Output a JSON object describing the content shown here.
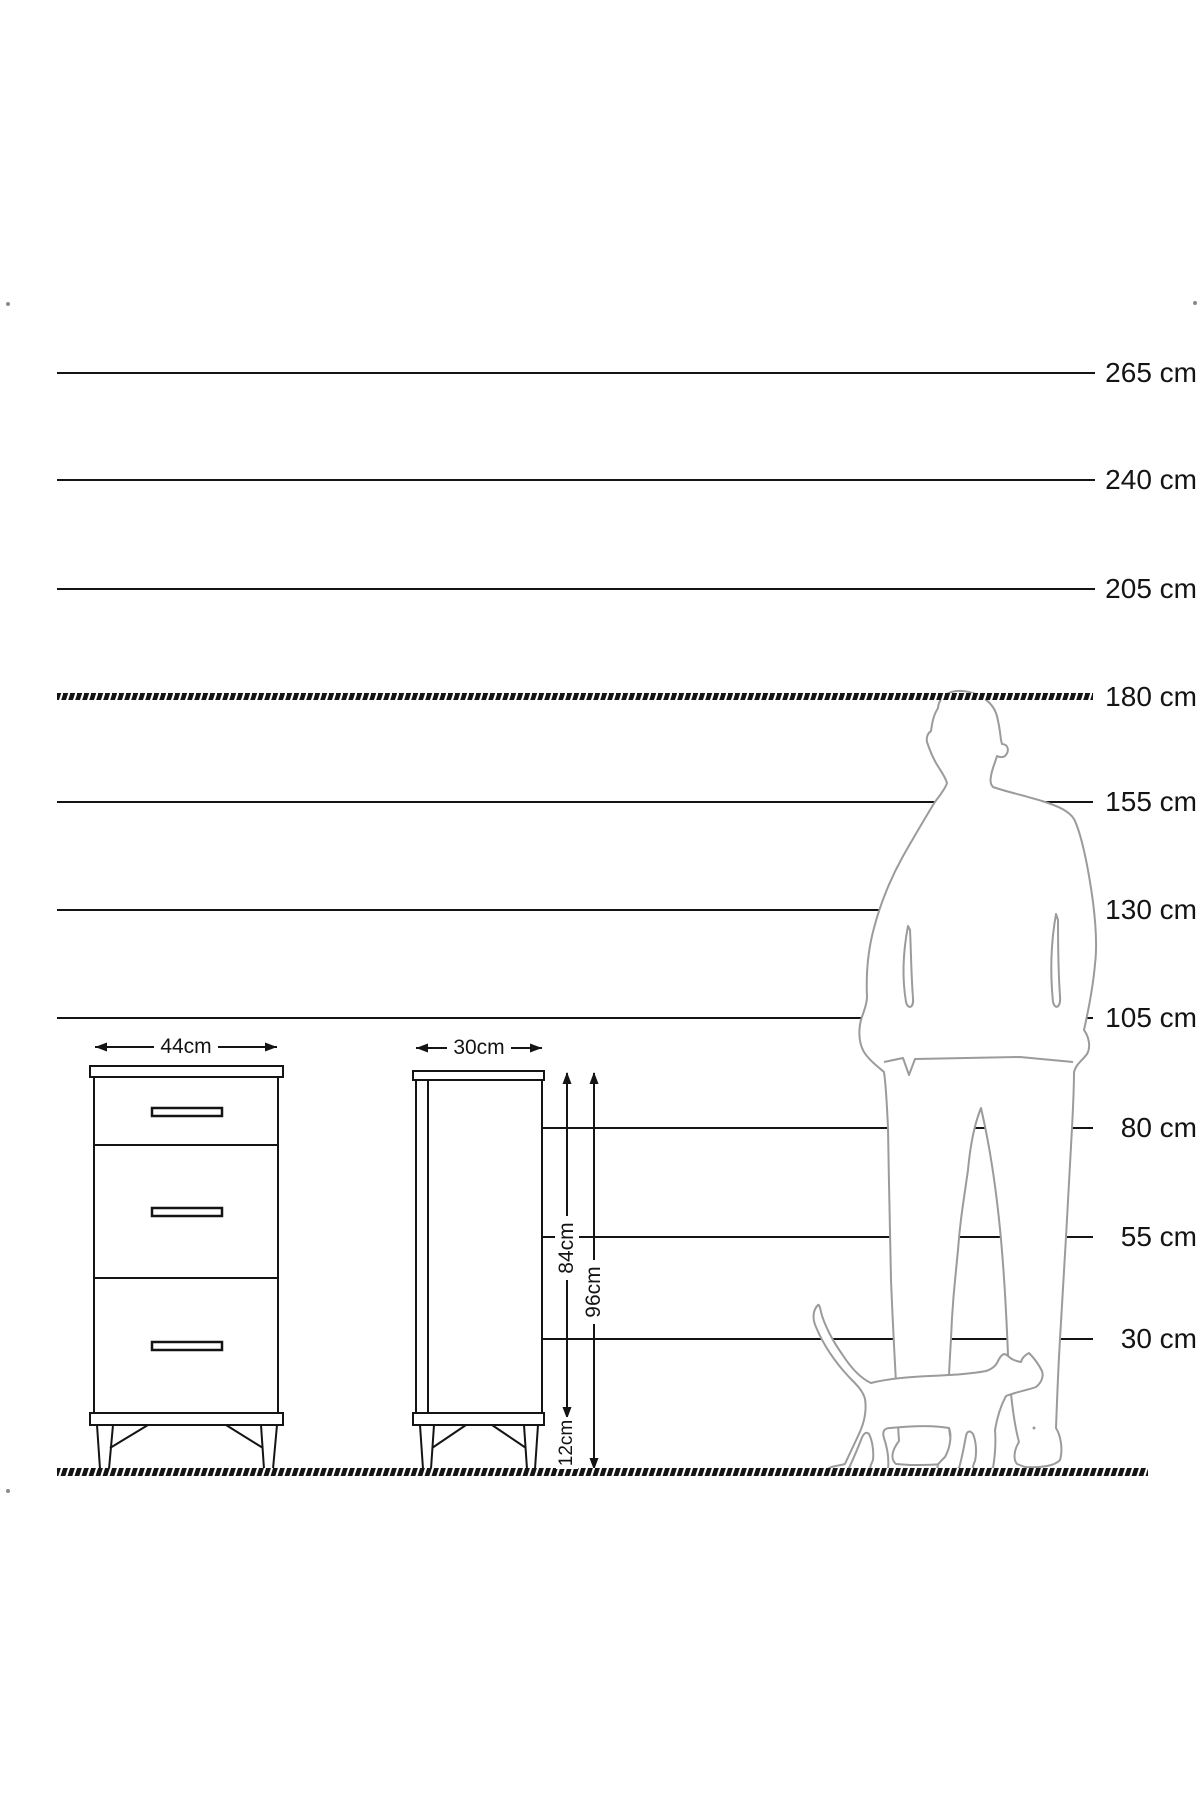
{
  "scale": {
    "unit": "cm",
    "labels": [
      {
        "value": 265,
        "text": "265 cm"
      },
      {
        "value": 240,
        "text": "240 cm"
      },
      {
        "value": 205,
        "text": "205 cm"
      },
      {
        "value": 180,
        "text": "180 cm"
      },
      {
        "value": 155,
        "text": "155 cm"
      },
      {
        "value": 130,
        "text": "130 cm"
      },
      {
        "value": 105,
        "text": "105 cm"
      },
      {
        "value": 80,
        "text": "80 cm"
      },
      {
        "value": 55,
        "text": "55 cm"
      },
      {
        "value": 30,
        "text": "30 cm"
      }
    ]
  },
  "furniture": {
    "front_view": {
      "width_label": "44cm",
      "drawers": 3
    },
    "side_view": {
      "depth_label": "30cm"
    },
    "dimensions": {
      "body_height_label": "84cm",
      "total_height_label": "96cm",
      "leg_height_label": "12cm"
    }
  },
  "figures": {
    "man": "man-silhouette",
    "cat": "cat-silhouette"
  },
  "colors": {
    "line": "#141414",
    "figure_outline": "#9b9b9b",
    "background": "#ffffff"
  }
}
